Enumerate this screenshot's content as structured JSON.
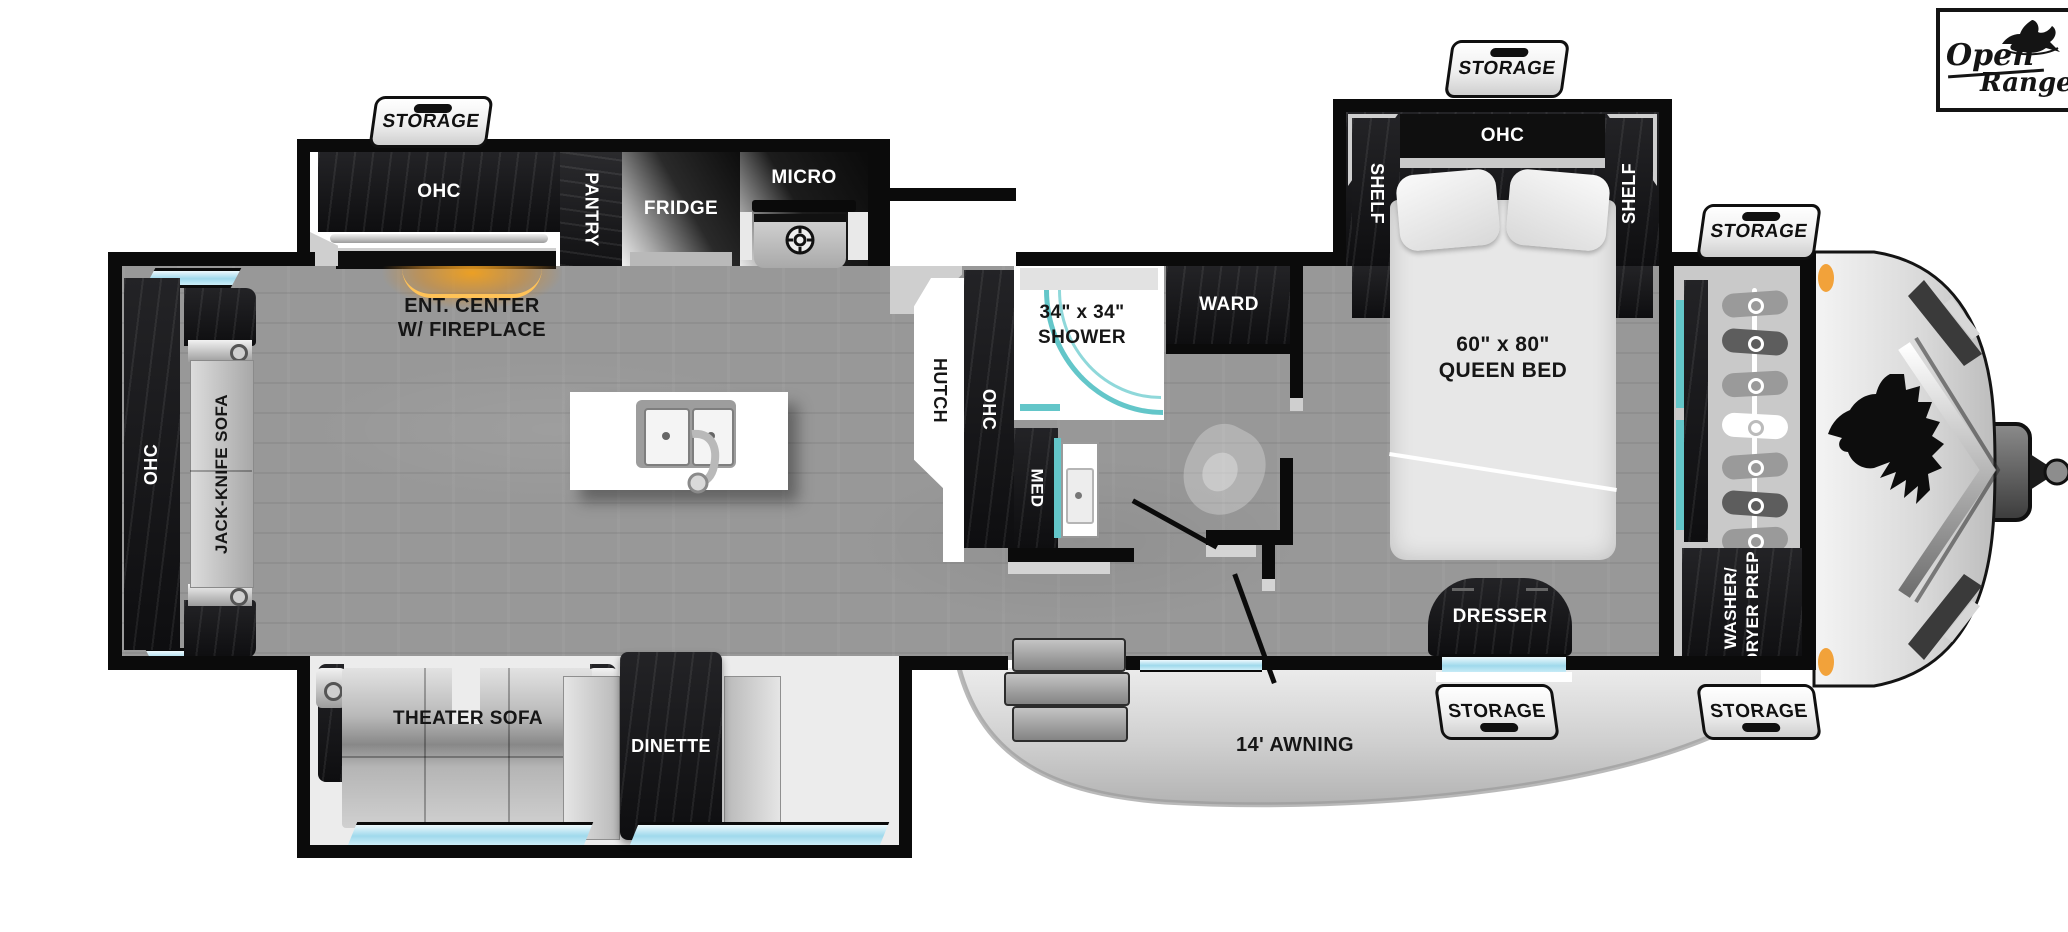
{
  "brand": {
    "open": "Open",
    "range": "Range"
  },
  "tags": {
    "storage": "STORAGE"
  },
  "rear": {
    "ohc": "OHC",
    "sofa": "JACK-KNIFE SOFA"
  },
  "kitchen": {
    "ohc": "OHC",
    "pantry": "PANTRY",
    "fridge": "FRIDGE",
    "micro": "MICRO",
    "ent_line1": "ENT. CENTER",
    "ent_line2": "W/ FIREPLACE"
  },
  "bath": {
    "hutch": "HUTCH",
    "ohc": "OHC",
    "shower_line1": "34\" x 34\"",
    "shower_line2": "SHOWER",
    "med": "MED",
    "ward": "WARD"
  },
  "bedroom": {
    "shelf_left": "SHELF",
    "ohc": "OHC",
    "shelf_right": "SHELF",
    "bed_line1": "60\" x 80\"",
    "bed_line2": "QUEEN BED",
    "dresser": "DRESSER"
  },
  "front": {
    "washer_line1": "WASHER/",
    "washer_line2": "DRYER PREP"
  },
  "lounge": {
    "theater_sofa": "THEATER SOFA",
    "dinette": "DINETTE"
  },
  "exterior": {
    "awning": "14' AWNING"
  },
  "colors": {
    "accent_teal": "#63c6c9",
    "window_blue": "#9fd9ec",
    "fireplace_orange": "#e08b1d",
    "marker_orange": "#f2a23a",
    "wall_black": "#0b0b0b"
  }
}
